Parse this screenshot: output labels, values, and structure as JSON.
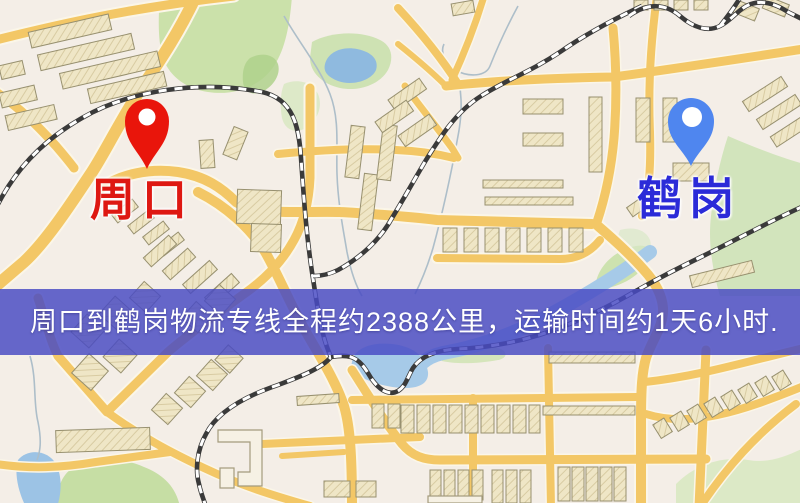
{
  "banner": {
    "text": "周口到鹤岗物流专线全程约2388公里，运输时间约1天6小时.",
    "bg_color": "#494BC4",
    "text_color": "#FFFFFF"
  },
  "markers": {
    "origin": {
      "label": "周口",
      "pin_color": "#E9150B",
      "label_color": "#DE1812"
    },
    "destination": {
      "label": "鹤岗",
      "pin_color": "#4F86EF",
      "label_color": "#2B2BD8"
    }
  },
  "map": {
    "background_color": "#F4EEE7",
    "road_color": "#F3C766",
    "railway_color": "#3A3A3A",
    "water_color": "#A6CAE8",
    "park_color": "#CBE1AA",
    "building_color": "#EFE6C6"
  }
}
